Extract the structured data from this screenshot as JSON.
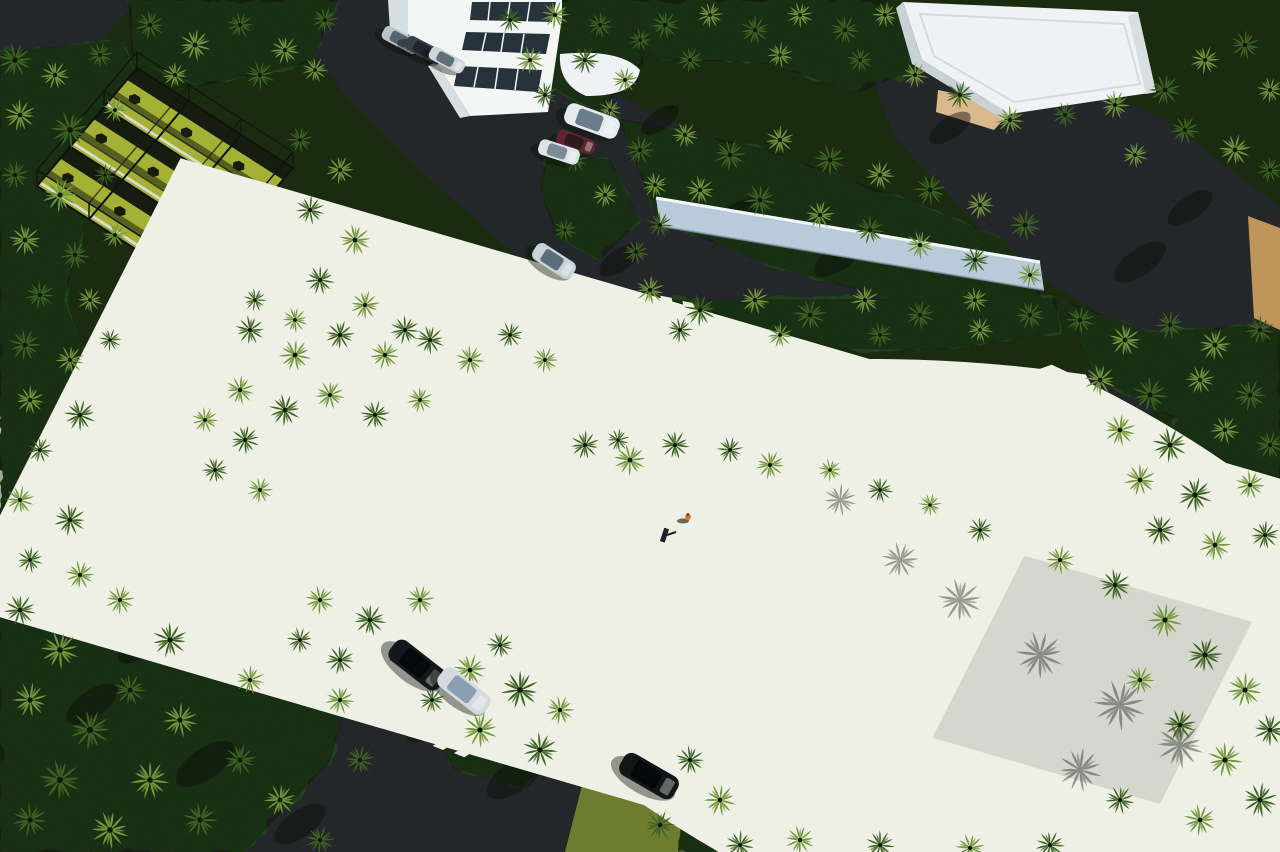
{
  "meta": {
    "title": "Aerial drone view of a tropical resort sports complex with palm groves",
    "type": "aerial-photograph",
    "time_of_day": "sunny daytime, long shadows toward lower-left"
  },
  "palette": {
    "asphalt": "#3d4245",
    "asphalt-dark": "#2c3134",
    "canopy-deep": "#1a2b10",
    "veg-blob": "#24401a",
    "frond-dark": "#203715",
    "frond-mid": "#3f6323",
    "frond-light": "#74963c",
    "frond-sun": "#a6bd55",
    "lawn": "#7f9029",
    "lawn-bright": "#93a537",
    "grass-band": "#87993a",
    "bball-green": "#8b961c",
    "pickle-turf": "#93a324",
    "pickle-court": "#a4b42c",
    "court-gray": "#b7beb8",
    "line-white": "#eef0e6",
    "fence": "#141a10",
    "cage-turf": "#a5b135",
    "cage-dark": "#161d10",
    "cage-white": "#d8dcd0",
    "wall-face": "#b9cbda",
    "wall-top": "#e9f1f6",
    "bld-white": "#f3f6f5",
    "bld-shade": "#d8dfe2",
    "window-dark": "#27333b",
    "roof-white": "#eef2f4",
    "sand": "#c0955a",
    "sand-light": "#d8b98e",
    "white-ground": "#dcdcd4",
    "shadow-ink": "#0a0e08",
    "person-orange": "#e2791f"
  },
  "scene": {
    "description": "Dense palm-tree grounds with a 3x3 netted practice cage (top-left), white multi-story building (top-center), white flat-roof pavilion (top-right), long white garden wall (center-right), two fenced pickleball courts (center-left) and a large olive-green basketball court (center-right), connected by dark asphalt drives and parking areas with scattered cars.",
    "facilities": [
      {
        "label": "netted practice cage, 3x3 bays"
      },
      {
        "label": "pickleball courts (2)"
      },
      {
        "label": "basketball court"
      },
      {
        "label": "multi-story building"
      },
      {
        "label": "flat-roof pavilion"
      },
      {
        "label": "walled garden"
      }
    ],
    "person": {
      "x": 688,
      "y": 517,
      "note": "person in orange on basketball court baseline"
    },
    "vehicles": [
      {
        "name": "suv-silver-road",
        "x": 554,
        "y": 261,
        "a": 33,
        "w": 46,
        "h": 19,
        "body": "#c9d2d8",
        "glass": "#5b6d7c"
      },
      {
        "name": "suv-white-top",
        "x": 592,
        "y": 121,
        "a": 20,
        "w": 56,
        "h": 22,
        "body": "#e6ebee",
        "glass": "#6b7d8a"
      },
      {
        "name": "car-dark-red",
        "x": 576,
        "y": 142,
        "a": 20,
        "w": 40,
        "h": 15,
        "body": "#5c2530",
        "glass": "#2c1a1f"
      },
      {
        "name": "car-white-top",
        "x": 559,
        "y": 152,
        "a": 18,
        "w": 42,
        "h": 16,
        "body": "#dde4e8",
        "glass": "#7b8b96"
      },
      {
        "name": "car-silver-row-1",
        "x": 401,
        "y": 40,
        "a": 28,
        "w": 40,
        "h": 15,
        "body": "#b9c3c9",
        "glass": "#55646f"
      },
      {
        "name": "car-dark-row-2",
        "x": 424,
        "y": 50,
        "a": 28,
        "w": 40,
        "h": 15,
        "body": "#3a4148",
        "glass": "#20262b"
      },
      {
        "name": "car-silver-row-3",
        "x": 447,
        "y": 60,
        "a": 28,
        "w": 38,
        "h": 14,
        "body": "#cfd6da",
        "glass": "#5f707b"
      },
      {
        "name": "suv-black-parked",
        "x": 417,
        "y": 665,
        "a": 38,
        "w": 62,
        "h": 25,
        "body": "#14181d",
        "glass": "#06090c"
      },
      {
        "name": "car-silver-parked",
        "x": 464,
        "y": 691,
        "a": 38,
        "w": 58,
        "h": 23,
        "body": "#d4dade",
        "glass": "#8aa0b0"
      },
      {
        "name": "suv-black-bottom",
        "x": 649,
        "y": 776,
        "a": 30,
        "w": 62,
        "h": 25,
        "body": "#121619",
        "glass": "#05080a"
      }
    ],
    "palm_shadows": [
      [
        140,
        646,
        26
      ],
      [
        92,
        704,
        30
      ],
      [
        205,
        764,
        34
      ],
      [
        300,
        824,
        30
      ],
      [
        358,
        648,
        24
      ],
      [
        432,
        722,
        30
      ],
      [
        516,
        776,
        34
      ],
      [
        252,
        486,
        20
      ],
      [
        334,
        436,
        22
      ],
      [
        560,
        330,
        26
      ],
      [
        660,
        120,
        22
      ],
      [
        736,
        216,
        26
      ],
      [
        838,
        258,
        28
      ],
      [
        950,
        128,
        24
      ],
      [
        1140,
        262,
        30
      ],
      [
        1190,
        208,
        26
      ],
      [
        620,
        260,
        24
      ],
      [
        700,
        330,
        26
      ],
      [
        160,
        560,
        22
      ],
      [
        250,
        420,
        20
      ]
    ],
    "court_shadows": [
      [
        900,
        560,
        1.0
      ],
      [
        960,
        600,
        1.2
      ],
      [
        1040,
        655,
        1.3
      ],
      [
        1120,
        705,
        1.4
      ],
      [
        1180,
        745,
        1.3
      ],
      [
        1080,
        770,
        1.2
      ],
      [
        840,
        500,
        0.9
      ]
    ],
    "palms": [
      [
        15,
        60,
        1.2,
        1
      ],
      [
        55,
        75,
        1.0,
        2
      ],
      [
        100,
        55,
        0.9,
        1
      ],
      [
        20,
        115,
        1.1,
        2
      ],
      [
        70,
        130,
        1.3,
        1
      ],
      [
        115,
        110,
        0.9,
        2
      ],
      [
        15,
        175,
        1.0,
        1
      ],
      [
        60,
        195,
        1.2,
        2
      ],
      [
        105,
        175,
        0.8,
        1
      ],
      [
        25,
        240,
        1.1,
        2
      ],
      [
        75,
        255,
        1.0,
        1
      ],
      [
        115,
        235,
        0.9,
        2
      ],
      [
        40,
        295,
        1.0,
        1
      ],
      [
        90,
        300,
        0.9,
        2
      ],
      [
        25,
        345,
        1.1,
        1
      ],
      [
        70,
        360,
        1.0,
        2
      ],
      [
        110,
        340,
        0.8,
        1
      ],
      [
        30,
        400,
        1.0,
        2
      ],
      [
        80,
        415,
        1.1,
        1
      ],
      [
        40,
        450,
        0.9,
        1
      ],
      [
        20,
        500,
        1.0,
        2
      ],
      [
        70,
        520,
        1.1,
        1
      ],
      [
        30,
        560,
        0.9,
        1
      ],
      [
        80,
        575,
        1.0,
        2
      ],
      [
        20,
        610,
        1.1,
        1
      ],
      [
        120,
        600,
        1.0,
        2
      ],
      [
        170,
        640,
        1.2,
        1
      ],
      [
        60,
        650,
        1.3,
        2
      ],
      [
        130,
        690,
        1.1,
        1
      ],
      [
        30,
        700,
        1.2,
        2
      ],
      [
        90,
        730,
        1.4,
        1
      ],
      [
        180,
        720,
        1.2,
        2
      ],
      [
        60,
        780,
        1.4,
        1
      ],
      [
        150,
        780,
        1.3,
        2
      ],
      [
        240,
        760,
        1.1,
        1
      ],
      [
        30,
        820,
        1.2,
        1
      ],
      [
        110,
        830,
        1.3,
        2
      ],
      [
        200,
        820,
        1.2,
        1
      ],
      [
        280,
        800,
        1.1,
        2
      ],
      [
        320,
        840,
        1.0,
        1
      ],
      [
        250,
        680,
        1.0,
        2
      ],
      [
        300,
        640,
        0.9,
        1
      ],
      [
        340,
        700,
        1.0,
        2
      ],
      [
        360,
        760,
        1.0,
        1
      ],
      [
        150,
        25,
        1.0,
        1
      ],
      [
        195,
        45,
        1.1,
        2
      ],
      [
        240,
        25,
        0.9,
        1
      ],
      [
        285,
        50,
        1.0,
        2
      ],
      [
        325,
        20,
        0.9,
        1
      ],
      [
        175,
        75,
        0.9,
        2
      ],
      [
        260,
        75,
        1.0,
        1
      ],
      [
        315,
        70,
        0.9,
        2
      ],
      [
        300,
        140,
        0.9,
        1
      ],
      [
        340,
        170,
        1.0,
        2
      ],
      [
        310,
        210,
        1.0,
        1
      ],
      [
        355,
        240,
        1.1,
        2
      ],
      [
        320,
        280,
        1.0,
        1
      ],
      [
        365,
        305,
        1.0,
        2
      ],
      [
        405,
        330,
        1.0,
        1
      ],
      [
        295,
        320,
        0.9,
        2
      ],
      [
        255,
        300,
        0.8,
        1
      ],
      [
        510,
        20,
        0.9,
        1
      ],
      [
        555,
        15,
        1.0,
        2
      ],
      [
        600,
        25,
        0.9,
        1
      ],
      [
        530,
        60,
        1.0,
        2
      ],
      [
        585,
        60,
        1.0,
        1
      ],
      [
        625,
        80,
        0.9,
        2
      ],
      [
        545,
        95,
        0.9,
        1
      ],
      [
        610,
        110,
        0.8,
        2
      ],
      [
        640,
        40,
        0.8,
        1
      ],
      [
        665,
        25,
        1.0,
        1
      ],
      [
        710,
        15,
        0.9,
        2
      ],
      [
        755,
        30,
        1.0,
        1
      ],
      [
        800,
        15,
        0.9,
        2
      ],
      [
        845,
        30,
        1.0,
        1
      ],
      [
        885,
        15,
        0.9,
        2
      ],
      [
        690,
        60,
        0.9,
        1
      ],
      [
        780,
        55,
        0.9,
        2
      ],
      [
        860,
        60,
        0.9,
        1
      ],
      [
        915,
        75,
        0.9,
        2
      ],
      [
        960,
        95,
        1.0,
        1
      ],
      [
        1010,
        120,
        1.0,
        2
      ],
      [
        1065,
        115,
        0.9,
        1
      ],
      [
        1115,
        105,
        1.0,
        2
      ],
      [
        1165,
        90,
        1.1,
        1
      ],
      [
        1205,
        60,
        1.0,
        2
      ],
      [
        1245,
        45,
        1.0,
        1
      ],
      [
        1270,
        90,
        0.9,
        2
      ],
      [
        1185,
        130,
        1.0,
        1
      ],
      [
        1235,
        150,
        1.1,
        2
      ],
      [
        1270,
        170,
        0.9,
        1
      ],
      [
        1135,
        155,
        0.9,
        2
      ],
      [
        640,
        150,
        1.0,
        1
      ],
      [
        685,
        135,
        0.9,
        2
      ],
      [
        730,
        155,
        1.1,
        1
      ],
      [
        780,
        140,
        1.0,
        2
      ],
      [
        830,
        160,
        1.1,
        1
      ],
      [
        880,
        175,
        1.0,
        2
      ],
      [
        930,
        190,
        1.1,
        1
      ],
      [
        980,
        205,
        1.0,
        2
      ],
      [
        1025,
        225,
        1.1,
        1
      ],
      [
        700,
        190,
        1.0,
        2
      ],
      [
        760,
        200,
        1.1,
        1
      ],
      [
        820,
        215,
        1.0,
        2
      ],
      [
        870,
        230,
        1.0,
        1
      ],
      [
        920,
        245,
        1.0,
        2
      ],
      [
        660,
        225,
        0.9,
        1
      ],
      [
        975,
        260,
        1.0,
        1
      ],
      [
        1030,
        275,
        0.9,
        2
      ],
      [
        650,
        290,
        1.0,
        2
      ],
      [
        700,
        310,
        1.1,
        1
      ],
      [
        755,
        300,
        1.0,
        2
      ],
      [
        810,
        315,
        1.1,
        1
      ],
      [
        865,
        300,
        1.0,
        2
      ],
      [
        920,
        315,
        1.0,
        1
      ],
      [
        975,
        300,
        0.9,
        2
      ],
      [
        1030,
        315,
        1.0,
        1
      ],
      [
        680,
        330,
        0.9,
        1
      ],
      [
        780,
        335,
        0.9,
        2
      ],
      [
        880,
        335,
        0.9,
        1
      ],
      [
        980,
        330,
        0.9,
        2
      ],
      [
        575,
        160,
        0.9,
        1
      ],
      [
        605,
        195,
        0.9,
        2
      ],
      [
        565,
        230,
        0.8,
        1
      ],
      [
        250,
        330,
        1.0,
        1
      ],
      [
        295,
        355,
        1.1,
        2
      ],
      [
        340,
        335,
        1.0,
        1
      ],
      [
        385,
        355,
        1.0,
        2
      ],
      [
        430,
        340,
        1.0,
        1
      ],
      [
        470,
        360,
        1.0,
        2
      ],
      [
        510,
        335,
        0.9,
        1
      ],
      [
        545,
        360,
        0.9,
        2
      ],
      [
        240,
        390,
        1.0,
        2
      ],
      [
        285,
        410,
        1.1,
        1
      ],
      [
        330,
        395,
        1.0,
        2
      ],
      [
        375,
        415,
        1.0,
        1
      ],
      [
        420,
        400,
        0.9,
        2
      ],
      [
        245,
        440,
        1.0,
        1
      ],
      [
        205,
        420,
        0.9,
        2
      ],
      [
        215,
        470,
        0.9,
        1
      ],
      [
        260,
        490,
        0.9,
        2
      ],
      [
        585,
        445,
        1.0,
        1
      ],
      [
        630,
        460,
        1.1,
        2
      ],
      [
        675,
        445,
        1.0,
        1
      ],
      [
        730,
        450,
        0.9,
        1
      ],
      [
        770,
        465,
        1.0,
        2
      ],
      [
        1080,
        320,
        1.0,
        1
      ],
      [
        1125,
        340,
        1.1,
        2
      ],
      [
        1170,
        325,
        1.0,
        1
      ],
      [
        1215,
        345,
        1.1,
        2
      ],
      [
        1260,
        330,
        1.0,
        1
      ],
      [
        1100,
        380,
        1.1,
        2
      ],
      [
        1150,
        395,
        1.2,
        1
      ],
      [
        1200,
        380,
        1.0,
        2
      ],
      [
        1250,
        395,
        1.1,
        1
      ],
      [
        1120,
        430,
        1.1,
        2
      ],
      [
        1170,
        445,
        1.2,
        1
      ],
      [
        1225,
        430,
        1.0,
        2
      ],
      [
        1270,
        445,
        1.0,
        1
      ],
      [
        1140,
        480,
        1.1,
        2
      ],
      [
        1195,
        495,
        1.2,
        1
      ],
      [
        1250,
        485,
        1.0,
        2
      ],
      [
        1160,
        530,
        1.1,
        1
      ],
      [
        1215,
        545,
        1.1,
        2
      ],
      [
        1265,
        535,
        1.0,
        1
      ],
      [
        830,
        470,
        0.8,
        2
      ],
      [
        880,
        490,
        0.9,
        1
      ],
      [
        930,
        505,
        0.8,
        2
      ],
      [
        980,
        530,
        0.9,
        1
      ],
      [
        1060,
        560,
        1.0,
        2
      ],
      [
        1115,
        585,
        1.1,
        1
      ],
      [
        1165,
        620,
        1.2,
        2
      ],
      [
        1205,
        655,
        1.2,
        1
      ],
      [
        1245,
        690,
        1.2,
        2
      ],
      [
        1270,
        730,
        1.1,
        1
      ],
      [
        1225,
        760,
        1.2,
        2
      ],
      [
        1180,
        725,
        1.1,
        1
      ],
      [
        1140,
        680,
        1.0,
        2
      ],
      [
        1260,
        800,
        1.2,
        1
      ],
      [
        1200,
        820,
        1.1,
        2
      ],
      [
        1120,
        800,
        1.0,
        1
      ],
      [
        470,
        670,
        1.1,
        2
      ],
      [
        520,
        690,
        1.3,
        1
      ],
      [
        480,
        730,
        1.2,
        2
      ],
      [
        540,
        750,
        1.2,
        1
      ],
      [
        500,
        645,
        0.9,
        1
      ],
      [
        560,
        710,
        1.0,
        2
      ],
      [
        432,
        700,
        0.9,
        1
      ],
      [
        320,
        600,
        1.0,
        2
      ],
      [
        370,
        620,
        1.1,
        1
      ],
      [
        420,
        600,
        1.0,
        2
      ],
      [
        340,
        660,
        1.0,
        1
      ],
      [
        400,
        655,
        0.9,
        2
      ],
      [
        690,
        760,
        1.0,
        1
      ],
      [
        720,
        800,
        1.1,
        2
      ],
      [
        660,
        825,
        1.0,
        1
      ],
      [
        740,
        845,
        1.0,
        1
      ],
      [
        800,
        840,
        1.0,
        2
      ],
      [
        880,
        845,
        1.0,
        1
      ],
      [
        970,
        848,
        1.0,
        2
      ],
      [
        1050,
        845,
        1.0,
        1
      ],
      [
        618,
        440,
        0.8,
        1
      ],
      [
        655,
        185,
        0.9,
        2
      ],
      [
        636,
        252,
        0.9,
        1
      ]
    ]
  }
}
